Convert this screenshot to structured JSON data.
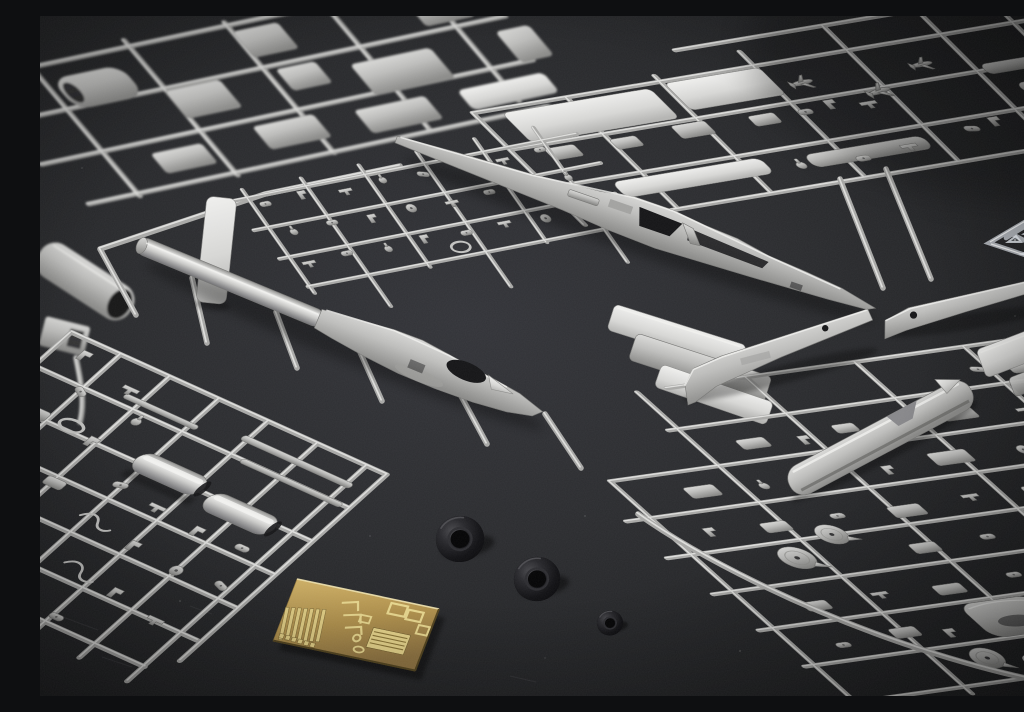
{
  "scene": {
    "title": "Plastic scale-model kit sprues laid out on a dark charcoal surface",
    "view": "overhead oblique studio photo",
    "depth_of_field": "top-left sprue out of focus, center sharp"
  },
  "palette": {
    "background_base": "#1f2022",
    "background_light": "#323338",
    "vignette": "#0a0b0d",
    "plastic_light": "#e7e7e5",
    "plastic_mid": "#b7b7b5",
    "plastic_dark": "#8a8a88",
    "runner_base": "#a8a8a6",
    "runner_highlight": "#e7e7e5",
    "tire_black": "#0b0b0d",
    "tire_highlight": "#48484c",
    "brass_mid": "#b2924c",
    "brass_light": "#e8d58a",
    "brass_dark": "#52431d",
    "clear_plastic": "rgba(236,242,250,0.7)"
  },
  "objects": {
    "gray_sprues": {
      "label": "light gray injection-molded sprues with aircraft parts",
      "count": 6
    },
    "clear_sprue": {
      "label": "clear-parts sprue, partially visible at right edge",
      "count": 1
    },
    "fuselage_halves": {
      "label": "long fuselage halves with tail booms and open cockpit cutouts",
      "count": 2
    },
    "tail_spine_halves": {
      "label": "slender tail spine halves on bottom-right sprue",
      "count": 2
    },
    "exhaust_cylinders": {
      "label": "cylindrical exhaust/pod halves on bottom-left sprue",
      "count": 2
    },
    "flat_panels": {
      "label": "flat wing / stabilizer panels",
      "count": 8
    },
    "wheel_hub_discs": {
      "label": "round wheel hub discs on bottom-right sprue",
      "count": 4
    },
    "rubber_tires": {
      "label": "black vinyl tires loose on the surface",
      "count": 3
    },
    "photo_etch_fret": {
      "label": "brass photo-etched detail fret",
      "count": 1
    }
  }
}
